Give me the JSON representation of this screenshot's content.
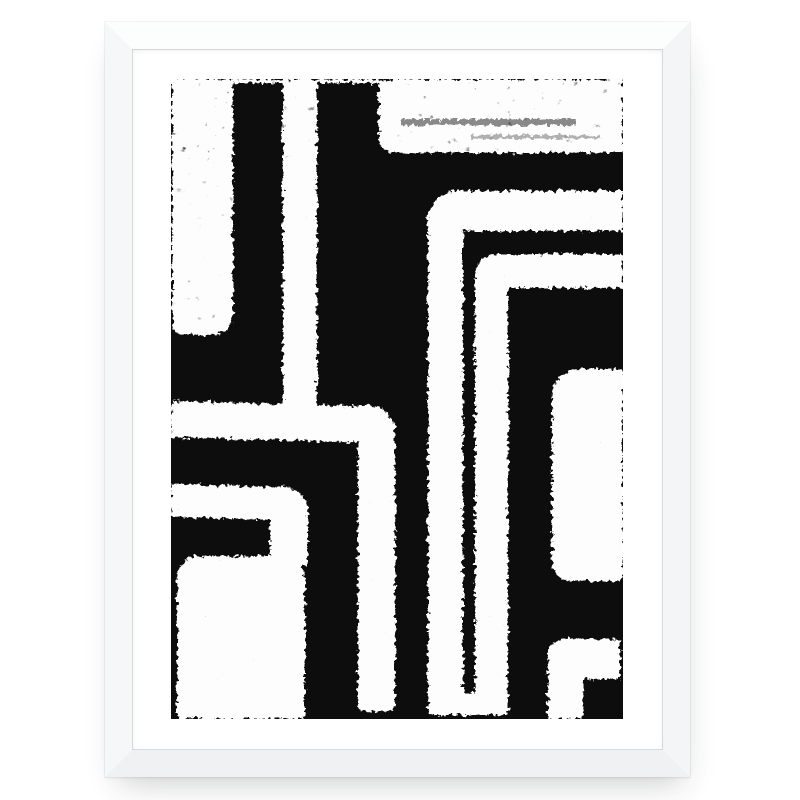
{
  "scene": {
    "type": "framed-art-print-mockup",
    "alt": "White wooden frame on a white wall holding an abstract black and white geometric line print with distressed grunge texture of nested rounded bands and blocks",
    "colors": {
      "wall": "#ffffff",
      "mat": "#ffffff",
      "frame_top": "#fcfdfd",
      "frame_right": "#f4f5f6",
      "frame_bottom": "#f0f1f3",
      "frame_left": "#f6f7f8",
      "art_black": "#0d0d0d",
      "art_white": "#fdfdfd"
    }
  },
  "frame": {
    "x": 105,
    "y": 22,
    "width": 585,
    "height": 755,
    "border": 27
  },
  "mat": {
    "art_left": 39,
    "art_top": 30
  },
  "artwork": {
    "width": 452,
    "height": 640,
    "shapes": [
      {
        "name": "top-edge-strip",
        "x": 0,
        "y": 0,
        "w": 452,
        "h": 4,
        "r": [
          0,
          0,
          0,
          0
        ]
      },
      {
        "name": "left-column",
        "x": 1,
        "y": 0,
        "w": 61,
        "h": 256,
        "r": [
          0,
          0,
          22,
          12
        ]
      },
      {
        "name": "center-left-column",
        "x": 112,
        "y": 0,
        "w": 34,
        "h": 328,
        "r": [
          0,
          0,
          0,
          0
        ]
      },
      {
        "name": "top-right-field",
        "x": 208,
        "y": 0,
        "w": 244,
        "h": 74,
        "r": [
          0,
          0,
          0,
          16
        ]
      },
      {
        "name": "band1-horizontal",
        "x": 0,
        "y": 322,
        "w": 224,
        "h": 36,
        "r": [
          0,
          28,
          0,
          0
        ],
        "tilt": 1.6
      },
      {
        "name": "band1-vertical",
        "x": 187,
        "y": 326,
        "w": 37,
        "h": 306,
        "r": [
          0,
          28,
          4,
          4
        ]
      },
      {
        "name": "band2-horizontal",
        "x": 0,
        "y": 405,
        "w": 137,
        "h": 33,
        "r": [
          0,
          24,
          0,
          0
        ],
        "tilt": 1.6
      },
      {
        "name": "band2-vertical",
        "x": 99,
        "y": 408,
        "w": 38,
        "h": 78,
        "r": [
          0,
          24,
          0,
          0
        ]
      },
      {
        "name": "bottom-left-block",
        "x": 6,
        "y": 477,
        "w": 128,
        "h": 163,
        "r": [
          22,
          22,
          3,
          3
        ]
      },
      {
        "name": "band3-horizontal",
        "x": 257,
        "y": 112,
        "w": 195,
        "h": 40,
        "r": [
          30,
          0,
          0,
          0
        ]
      },
      {
        "name": "band3-vertical",
        "x": 257,
        "y": 112,
        "w": 35,
        "h": 524,
        "r": [
          30,
          0,
          3,
          3
        ]
      },
      {
        "name": "band4-horizontal",
        "x": 304,
        "y": 175,
        "w": 148,
        "h": 34,
        "r": [
          22,
          0,
          0,
          0
        ]
      },
      {
        "name": "band4-vertical",
        "x": 304,
        "y": 175,
        "w": 33,
        "h": 461,
        "r": [
          22,
          0,
          3,
          3
        ]
      },
      {
        "name": "bands-bridge",
        "x": 288,
        "y": 614,
        "w": 20,
        "h": 22,
        "r": [
          0,
          0,
          0,
          0
        ]
      },
      {
        "name": "right-block",
        "x": 381,
        "y": 290,
        "w": 71,
        "h": 212,
        "r": [
          28,
          4,
          4,
          18
        ]
      },
      {
        "name": "band5-horizontal",
        "x": 377,
        "y": 560,
        "w": 72,
        "h": 40,
        "r": [
          16,
          0,
          0,
          0
        ]
      },
      {
        "name": "band5-vertical",
        "x": 377,
        "y": 560,
        "w": 35,
        "h": 80,
        "r": [
          16,
          0,
          0,
          3
        ]
      }
    ],
    "accents": [
      {
        "name": "speckle-streak",
        "x": 230,
        "y": 40,
        "w": 175,
        "h": 6,
        "opacity": 0.5
      },
      {
        "name": "speckle-streak-2",
        "x": 300,
        "y": 56,
        "w": 130,
        "h": 4,
        "opacity": 0.3
      }
    ],
    "texture": {
      "grain_opacity": 0.85,
      "top_mottle_opacity": 0.5,
      "left_mottle_opacity": 0.4
    }
  }
}
